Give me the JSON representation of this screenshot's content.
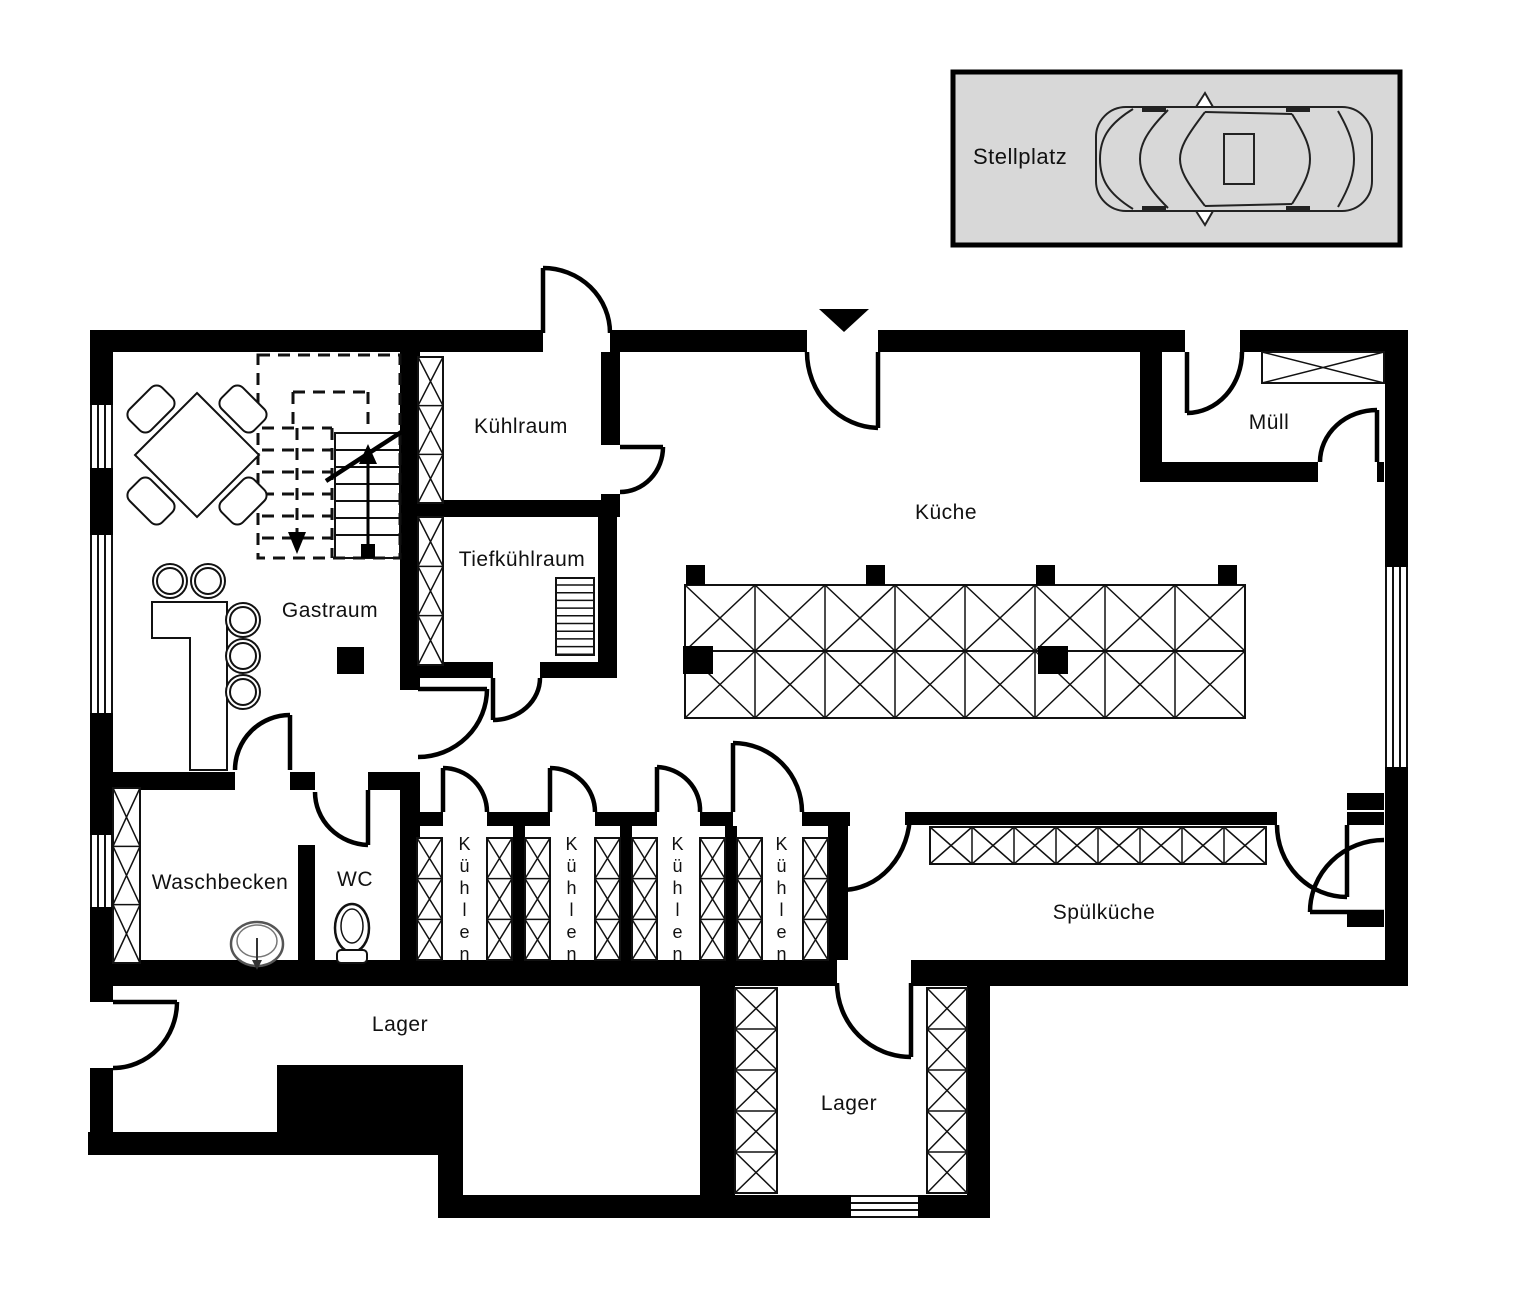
{
  "stellplatz": {
    "label": "Stellplatz"
  },
  "rooms": {
    "kuehlraum": "Kühlraum",
    "tiefkuehlraum": "Tiefkühlraum",
    "kueche": "Küche",
    "muell": "Müll",
    "gastraum": "Gastraum",
    "waschbecken": "Waschbecken",
    "wc": "WC",
    "kuehlen_1": "Kühlen",
    "kuehlen_2": "Kühlen",
    "kuehlen_3": "Kühlen",
    "kuehlen_4": "Kühlen",
    "spuelkueche": "Spülküche",
    "lager_left": "Lager",
    "lager_right": "Lager"
  },
  "symbols": {
    "car": "car-top-view",
    "sink": "sink",
    "toilet": "toilet",
    "stairs": "staircase-with-up-down-arrows",
    "entrance_arrow": "entrance-arrow",
    "insulated_wall": "x-hatched-panel",
    "window": "window",
    "door": "door-swing-arc"
  },
  "colors": {
    "wall": "#000000",
    "line": "#111111",
    "background": "#ffffff",
    "stellplatz_fill": "#d8d8d8"
  }
}
